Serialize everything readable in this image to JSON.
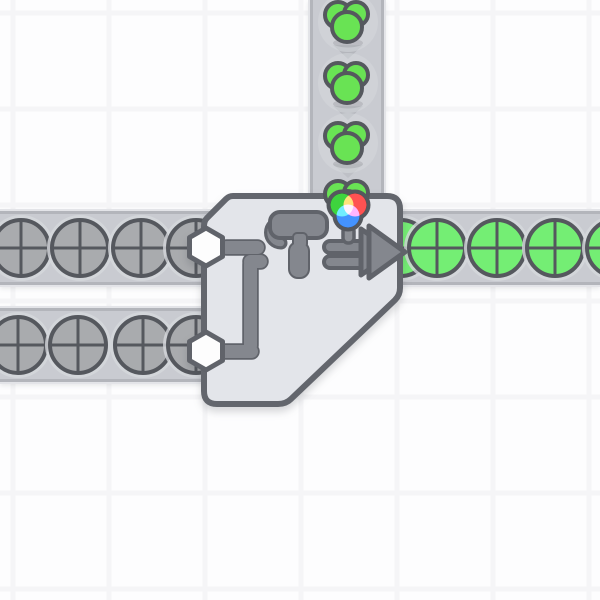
{
  "game": {
    "name": "shapez-factory-view",
    "scene_description": "painter machine joining two shape belts and one color belt"
  },
  "palette": {
    "background": "#fdfdfe",
    "grid_line": "#f5f5f7",
    "belt_fill": "#c9cbd1",
    "belt_edge": "#b3b5bb",
    "belt_outer": "#e3e4e8",
    "belt_arrow": "#b4b6bc",
    "item_backdrop": "#d6d8dc",
    "shape_outline": "#55585e",
    "shape_uncolored": "#a9abae",
    "shape_green": "#74ee74",
    "color_green": "#69e354",
    "machine_fill": "#e3e5ea",
    "machine_border": "#63666d",
    "icon_fill": "#84878e",
    "icon_border": "#60636a",
    "hexagon_fill": "#fdfdfd",
    "stem_fill": "#8d9096",
    "wheel_green": "#3ed43e",
    "wheel_red": "#ff5252",
    "wheel_blue": "#4493ff"
  },
  "grid": {
    "tile_size": 96,
    "offset_x": 13,
    "offset_y": 13,
    "line_width": 5
  },
  "scene": {
    "belts": [
      {
        "name": "conveyor-belt-row-top",
        "dir": "right",
        "x": 0,
        "y": 211,
        "w": 600,
        "h": 74
      },
      {
        "name": "conveyor-belt-row-bottom",
        "dir": "right",
        "x": 0,
        "y": 308,
        "w": 280,
        "h": 74
      },
      {
        "name": "conveyor-belt-column-top",
        "dir": "down",
        "x": 310,
        "y": 0,
        "w": 74,
        "h": 210
      }
    ],
    "belt_arrows": [
      {
        "x": 348,
        "y": 52,
        "dir": "down",
        "opacity": 1
      },
      {
        "x": 348,
        "y": 113,
        "dir": "down",
        "opacity": 1
      },
      {
        "x": 348,
        "y": 171,
        "dir": "down",
        "opacity": 0.5
      }
    ],
    "items": [
      {
        "type": "circle",
        "color": "uncolored",
        "x": 21,
        "y": 248
      },
      {
        "type": "circle",
        "color": "uncolored",
        "x": 80,
        "y": 248
      },
      {
        "type": "circle",
        "color": "uncolored",
        "x": 141,
        "y": 248
      },
      {
        "type": "circle",
        "color": "uncolored",
        "x": 196,
        "y": 248
      },
      {
        "type": "circle",
        "color": "uncolored",
        "x": 18,
        "y": 345
      },
      {
        "type": "circle",
        "color": "uncolored",
        "x": 78,
        "y": 345
      },
      {
        "type": "circle",
        "color": "uncolored",
        "x": 143,
        "y": 345
      },
      {
        "type": "circle",
        "color": "uncolored",
        "x": 196,
        "y": 345
      },
      {
        "type": "circle",
        "color": "green",
        "x": 401,
        "y": 248
      },
      {
        "type": "circle",
        "color": "green",
        "x": 437,
        "y": 248
      },
      {
        "type": "circle",
        "color": "green",
        "x": 497,
        "y": 248
      },
      {
        "type": "circle",
        "color": "green",
        "x": 555,
        "y": 248
      },
      {
        "type": "circle",
        "color": "green",
        "x": 615,
        "y": 248
      },
      {
        "type": "color-blob",
        "color": "green",
        "x": 348,
        "y": 22
      },
      {
        "type": "color-blob",
        "color": "green",
        "x": 348,
        "y": 83
      },
      {
        "type": "color-blob",
        "color": "green",
        "x": 348,
        "y": 143
      }
    ],
    "overlay_items": [
      {
        "type": "color-blob",
        "color": "green",
        "x": 348,
        "y": 201
      }
    ],
    "machine": {
      "type": "painter-double",
      "x": 204,
      "y": 196,
      "width": 196,
      "height": 208,
      "inputs": [
        {
          "kind": "shape",
          "from": "left",
          "lane": "top"
        },
        {
          "kind": "shape",
          "from": "left",
          "lane": "bottom"
        },
        {
          "kind": "color",
          "from": "top"
        }
      ],
      "output": {
        "kind": "painted-shape",
        "to": "right"
      },
      "hexagon_connectors": [
        {
          "x": 206,
          "y": 247
        },
        {
          "x": 206,
          "y": 351
        }
      ]
    }
  }
}
